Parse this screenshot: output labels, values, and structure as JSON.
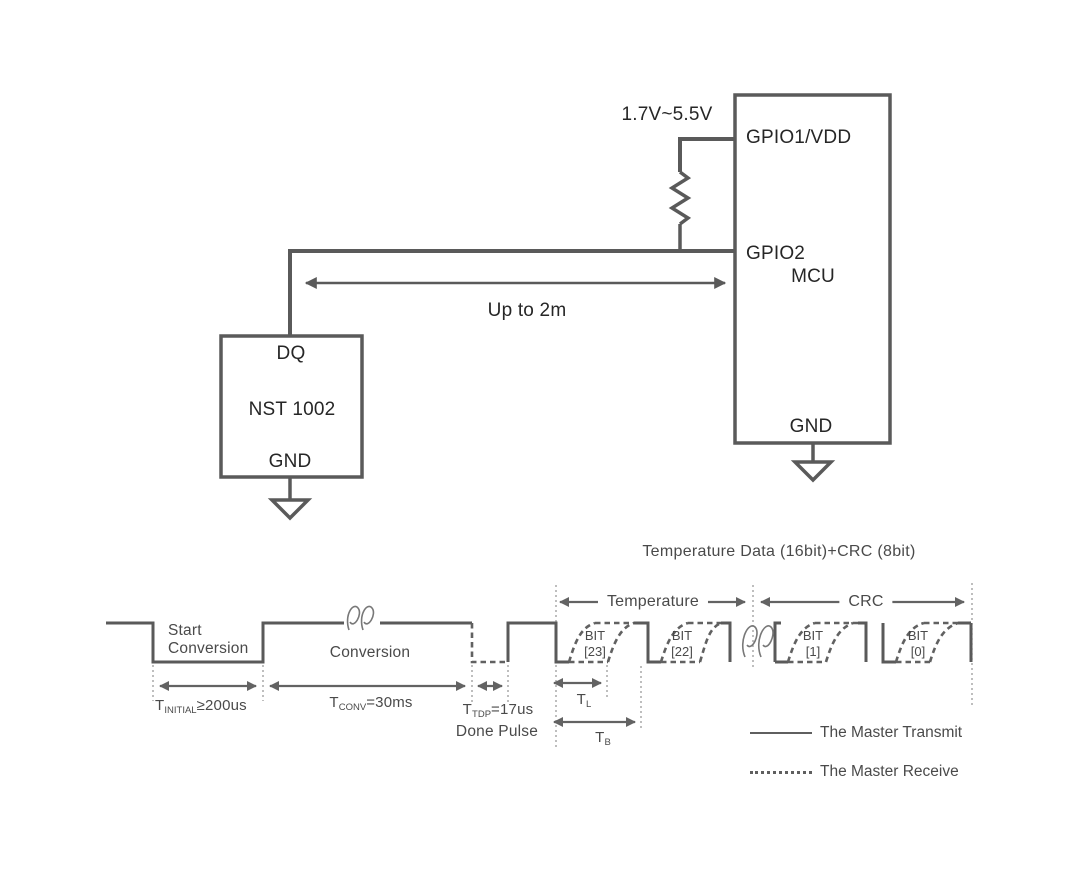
{
  "circuit": {
    "supply_label": "1.7V~5.5V",
    "wire_label": "Up to 2m",
    "mcu": {
      "pin_top": "GPIO1/VDD",
      "pin_data": "GPIO2",
      "name": "MCU",
      "pin_gnd": "GND"
    },
    "sensor": {
      "pin_data": "DQ",
      "name": "NST 1002",
      "pin_gnd": "GND"
    }
  },
  "timing": {
    "title": "Temperature Data (16bit)+CRC (8bit)",
    "sections": {
      "temperature": "Temperature",
      "crc": "CRC"
    },
    "phases": {
      "start_line1": "Start",
      "start_line2": "Conversion",
      "conversion": "Conversion",
      "done_pulse": "Done Pulse"
    },
    "bits": [
      {
        "line1": "BIT",
        "line2": "[23]"
      },
      {
        "line1": "BIT",
        "line2": "[22]"
      },
      {
        "line1": "BIT",
        "line2": "[1]"
      },
      {
        "line1": "BIT",
        "line2": "[0]"
      }
    ],
    "params": {
      "t_initial": {
        "base": "T",
        "sub": "INITIAL",
        "rest": "≥200us"
      },
      "t_conv": {
        "base": "T",
        "sub": "CONV",
        "rest": "=30ms"
      },
      "t_tdp": {
        "base": "T",
        "sub": "TDP",
        "rest": "=17us"
      },
      "t_l": {
        "base": "T",
        "sub": "L",
        "rest": ""
      },
      "t_b": {
        "base": "T",
        "sub": "B",
        "rest": ""
      }
    },
    "legend": [
      {
        "style": "solid",
        "label": "The Master Transmit"
      },
      {
        "style": "dotted",
        "label": "The Master Receive"
      }
    ]
  },
  "colors": {
    "wire": "#5a5a5a",
    "dashed_line": "#616161",
    "arrow": "#636363",
    "guide": "#9b9b9b",
    "circuit_text": "#262626",
    "timing_text": "#4a4a4a"
  }
}
